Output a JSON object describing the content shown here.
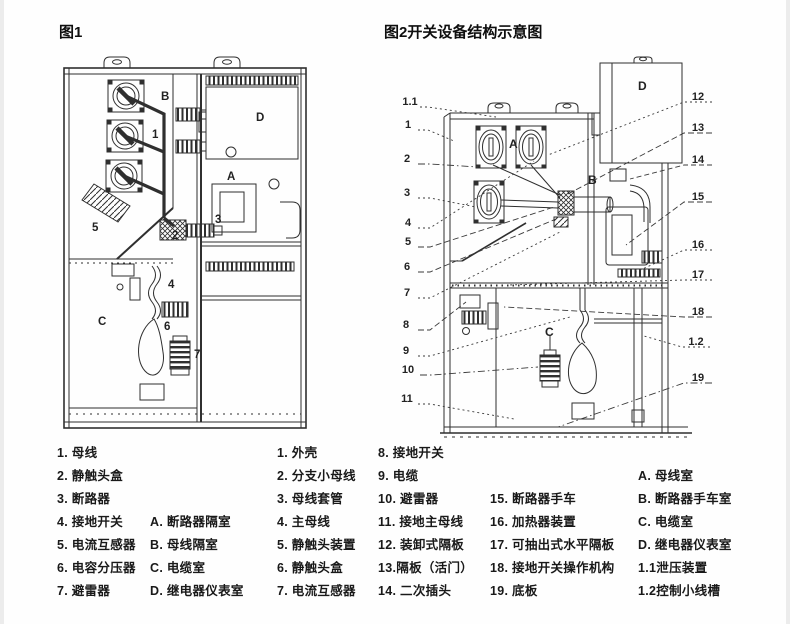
{
  "figure1": {
    "title": "图1",
    "labels": {
      "b": "B",
      "n1": "1",
      "d": "D",
      "a": "A",
      "n3": "3",
      "n2": "2",
      "n5": "5",
      "n4": "4",
      "c": "C",
      "n6": "6",
      "n7": "7"
    }
  },
  "figure2": {
    "title": "图2开关设备结构示意图",
    "left_callouts": [
      "1.1",
      "1",
      "2",
      "3",
      "4",
      "5",
      "6",
      "7",
      "8",
      "9",
      "10",
      "11"
    ],
    "right_callouts": [
      "12",
      "13",
      "14",
      "15",
      "16",
      "17",
      "18",
      "1.2",
      "19"
    ],
    "rooms": {
      "a": "A",
      "b": "B",
      "c": "C",
      "d": "D"
    }
  },
  "legend": {
    "fig1_items": [
      "1. 母线",
      "2. 静触头盒",
      "3. 断路器",
      "4. 接地开关",
      "5. 电流互感器",
      "6. 电容分压器",
      "7. 避雷器"
    ],
    "fig1_rooms": [
      "A. 断路器隔室",
      "B. 母线隔室",
      "C. 电缆室",
      "D. 继电器仪表室"
    ],
    "fig2_items_a": [
      "1. 外壳",
      "2. 分支小母线",
      "3. 母线套管",
      "4. 主母线",
      "5. 静触头装置",
      "6. 静触头盒",
      "7. 电流互感器"
    ],
    "fig2_items_b": [
      "8. 接地开关",
      "9. 电缆",
      "10. 避雷器",
      "11. 接地主母线",
      "12. 装卸式隔板",
      "13.隔板（活门）",
      "14. 二次插头"
    ],
    "fig2_items_c": [
      "15. 断路器手车",
      "16. 加热器装置",
      "17. 可抽出式水平隔板",
      "18. 接地开关操作机构",
      "19. 底板"
    ],
    "fig2_rooms": [
      "A. 母线室",
      "B. 断路器手车室",
      "C. 电缆室",
      "D. 继电器仪表室",
      "1.1泄压装置",
      "1.2控制小线槽"
    ]
  }
}
